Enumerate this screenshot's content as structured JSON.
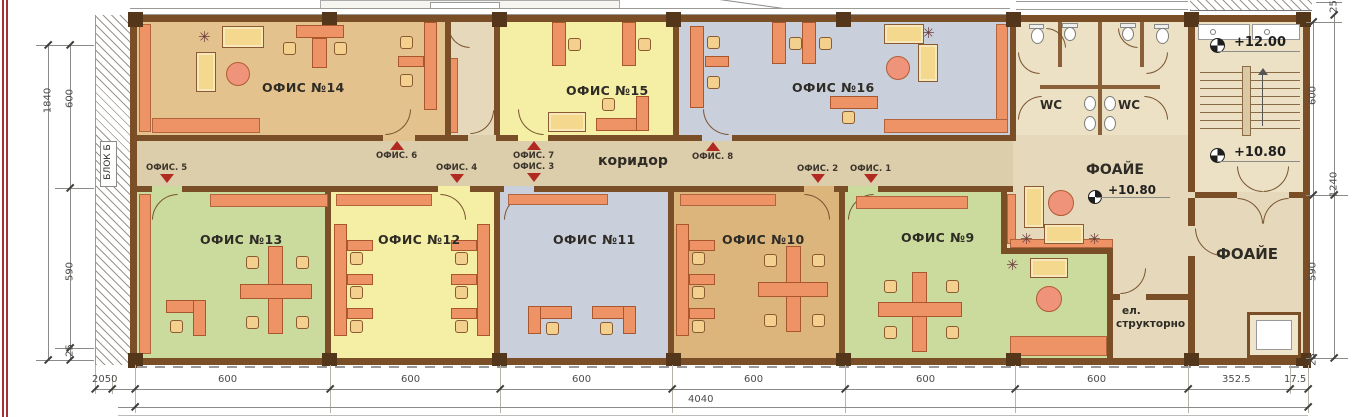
{
  "labels": {
    "corridor": "коридор",
    "block": "БЛОК Б",
    "foyer_mid": "ФОАЙЕ",
    "foyer_right": "ФОАЙЕ",
    "wc_left": "WC",
    "wc_right": "WC",
    "el_line1": "ел.",
    "el_line2": "структорно"
  },
  "rooms": {
    "o14": "ОФИС №14",
    "o15": "ОФИС №15",
    "o16": "ОФИС №16",
    "o13": "ОФИС №13",
    "o12": "ОФИС №12",
    "o11": "ОФИС №11",
    "o10": "ОФИС №10",
    "o9": "ОФИС №9"
  },
  "doors": {
    "d1": "ОФИС. 1",
    "d2": "ОФИС. 2",
    "d3": "ОФИС. 3",
    "d4": "ОФИС. 4",
    "d5": "ОФИС. 5",
    "d6": "ОФИС. 6",
    "d7": "ОФИС. 7",
    "d8": "ОФИС. 8"
  },
  "elevations": {
    "stair_top": "+12.00",
    "stair_bottom": "+10.80",
    "foyer": "+10.80"
  },
  "dimensions": {
    "bottom": [
      "2050",
      "600",
      "600",
      "600",
      "600",
      "600",
      "600",
      "352.5",
      "17.5"
    ],
    "total": "4040",
    "left_outer": "1840",
    "left": [
      "600",
      "590",
      "25"
    ],
    "right": [
      "25",
      "600",
      "1240",
      "590",
      "25"
    ]
  },
  "icons": {
    "plant": "✳"
  }
}
